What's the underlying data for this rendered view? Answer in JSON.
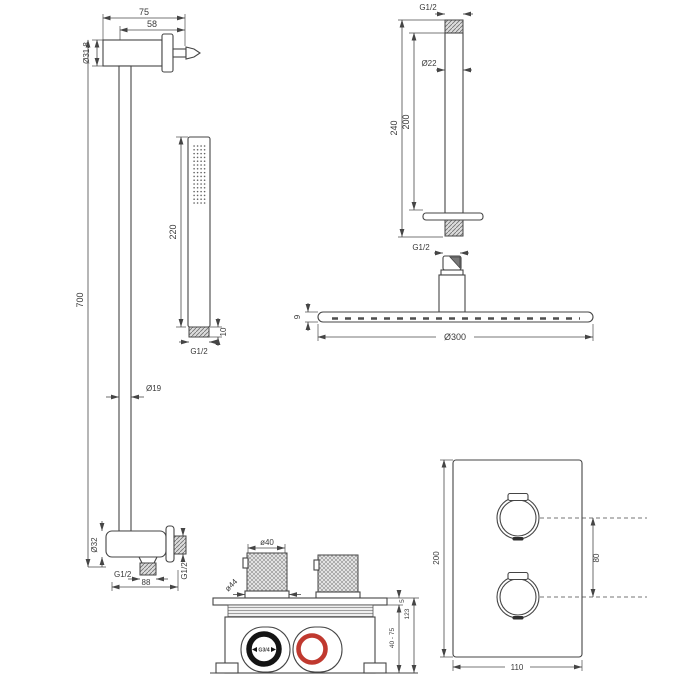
{
  "diagram": {
    "background": "#ffffff",
    "line_color": "#454545",
    "accent_red": "#c0392f",
    "slide_rail": {
      "bracket_depth": "75",
      "bracket_offset": "58",
      "bracket_diameter": "Ø31.8",
      "rail_length": "700",
      "rail_diameter": "Ø19",
      "elbow_diameter": "Ø32",
      "outlet_thread": "G1/2",
      "outlet_width": "88",
      "wall_thread": "G1/2"
    },
    "hand_shower": {
      "length": "220",
      "connector_height": "10",
      "thread": "G1/2"
    },
    "ceiling_arm": {
      "top_thread": "G1/2",
      "pipe_diameter": "Ø22",
      "exposed_length": "200",
      "total_length": "240",
      "bottom_thread": "G1/2"
    },
    "head_shower": {
      "thickness": "9",
      "diameter": "Ø300"
    },
    "mixer_valve": {
      "knob_diameter": "ø40",
      "knob_base_diameter": "ø44",
      "plate_thickness": "5",
      "built_in_depth": "40 - 75",
      "total_height": "123",
      "inlet_thread": "G3/4"
    },
    "trim_plate": {
      "height": "200",
      "width": "110",
      "knob_spacing": "80"
    }
  }
}
